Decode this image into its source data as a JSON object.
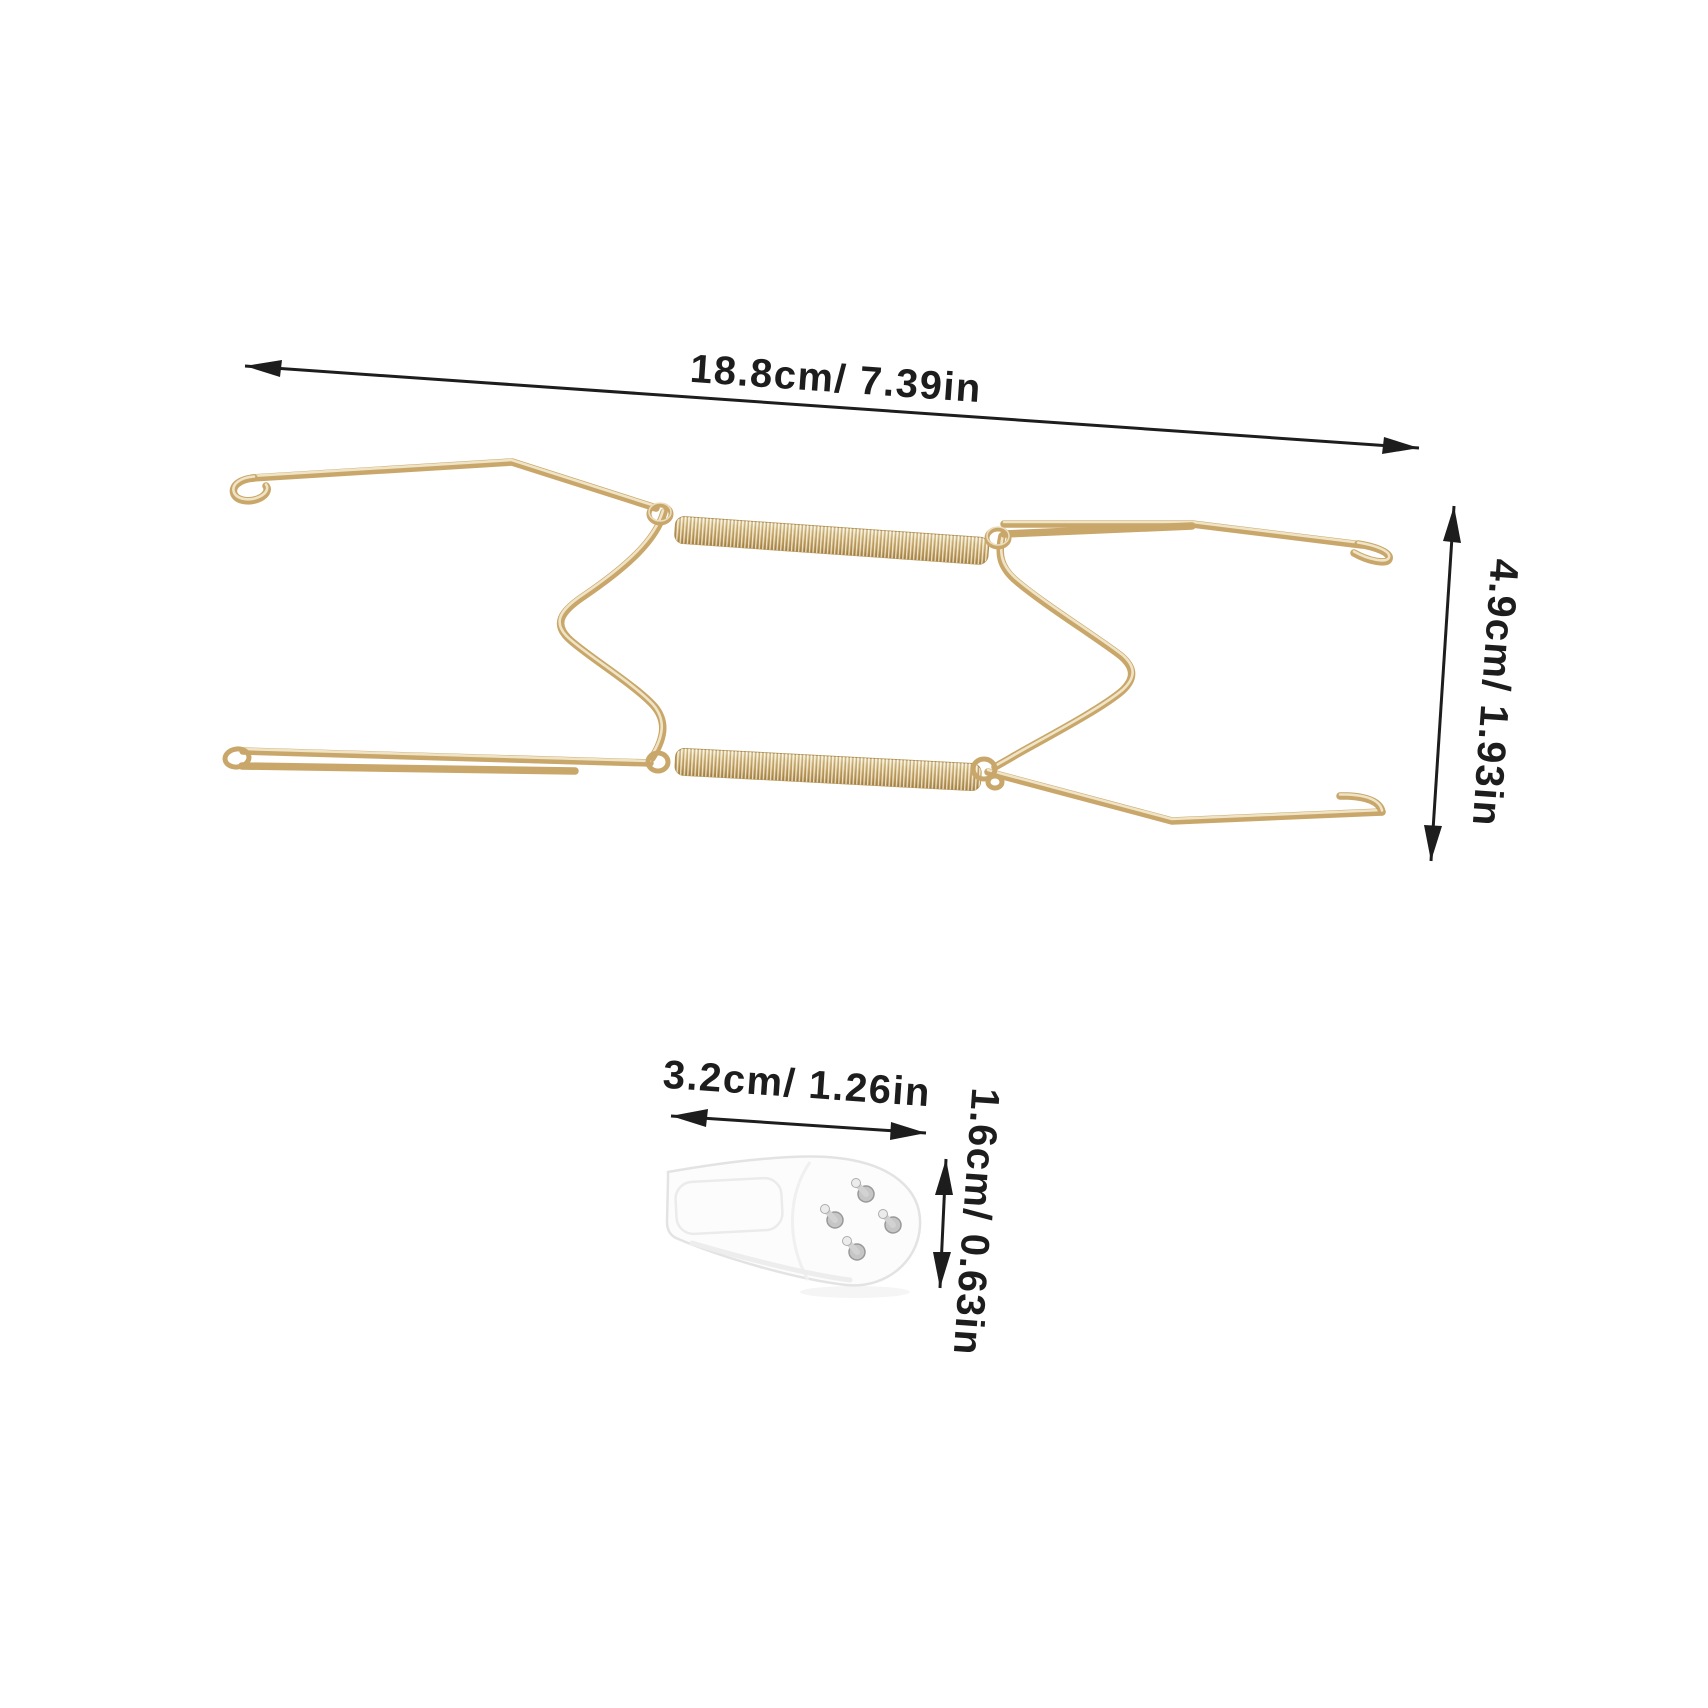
{
  "page": {
    "background": "#ffffff"
  },
  "dimension_labels": {
    "hanger_width": "18.8cm/ 7.39in",
    "hanger_height": "4.9cm/ 1.93in",
    "hook_width": "3.2cm/ 1.26in",
    "hook_height": "1.6cm/ 0.63in"
  },
  "graphics": {
    "plate_hanger": "gold-wire-plate-hanger-with-two-springs",
    "wall_hook": "white-plastic-wall-hook-with-four-metal-pins"
  },
  "colors": {
    "background": "#ffffff",
    "dimension_text": "#1d1d1d",
    "arrow": "#1d1d1d",
    "wire_gold": "#c9a76a",
    "wire_gold_highlight": "#f4ebd2",
    "spring_gold_light": "#f2e6c2",
    "spring_gold_dark": "#b08c4b",
    "hook_body": "#fcfcfc",
    "hook_outline": "#e3e3e3",
    "pin_metal": "#c6c6c6"
  }
}
